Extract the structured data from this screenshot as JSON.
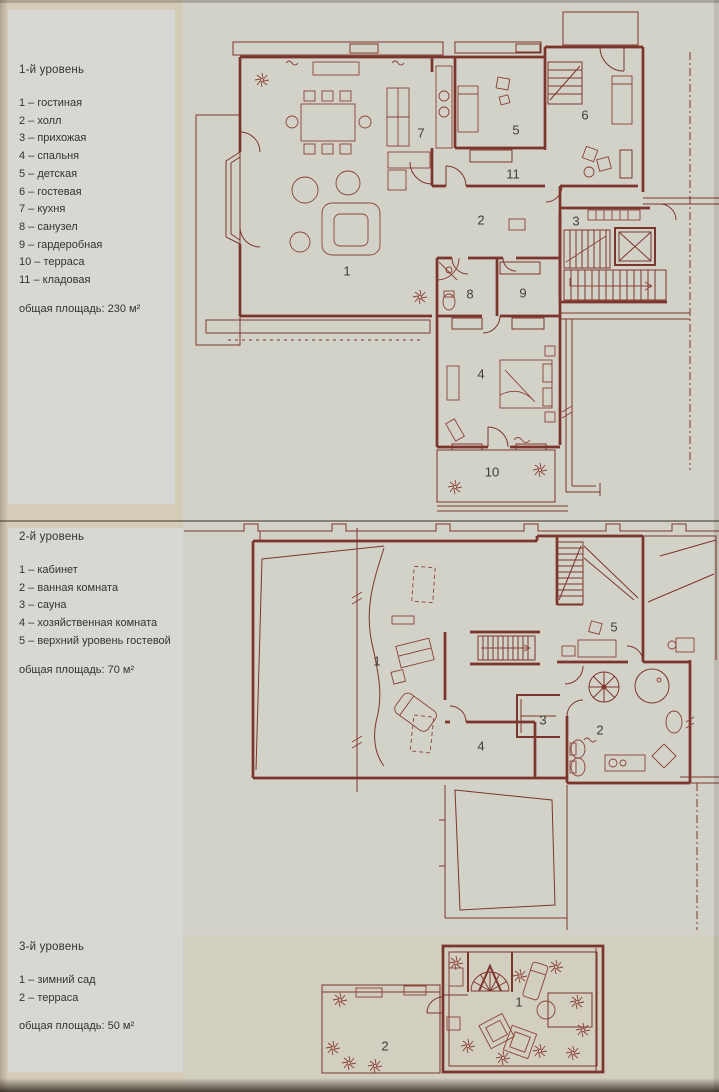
{
  "colors": {
    "page_background": "#d5ccb8",
    "panel_background": "#d3d2c9",
    "legend_background": "#d7d8d3",
    "plan_line": "#7c352c",
    "divider_line": "#6e6457",
    "text": "#35332e"
  },
  "legends": [
    {
      "title": "1-й уровень",
      "items": [
        "1 – гостиная",
        "2 – холл",
        "3 – прихожая",
        "4 – спальня",
        "5 – детская",
        "6 – гостевая",
        "7 – кухня",
        "8 – санузел",
        "9 – гардеробная",
        "10 – терраса",
        "11 – кладовая"
      ],
      "total": "общая площадь: 230 м²"
    },
    {
      "title": "2-й уровень",
      "items": [
        "1 – кабинет",
        "2 – ванная комната",
        "3 – сауна",
        "4 – хозяйственная комната",
        "5 – верхний уровень гостевой"
      ],
      "total": "общая площадь: 70 м²"
    },
    {
      "title": "3-й уровень",
      "items": [
        "1 – зимний сад",
        "2 – терраса"
      ],
      "total": "общая площадь:  50 м²"
    }
  ],
  "plans": [
    {
      "id": "level-1",
      "rooms": [
        "1",
        "2",
        "3",
        "4",
        "5",
        "6",
        "7",
        "8",
        "9",
        "10",
        "11"
      ]
    },
    {
      "id": "level-2",
      "rooms": [
        "1",
        "2",
        "3",
        "4",
        "5"
      ]
    },
    {
      "id": "level-3",
      "rooms": [
        "1",
        "2"
      ]
    }
  ]
}
